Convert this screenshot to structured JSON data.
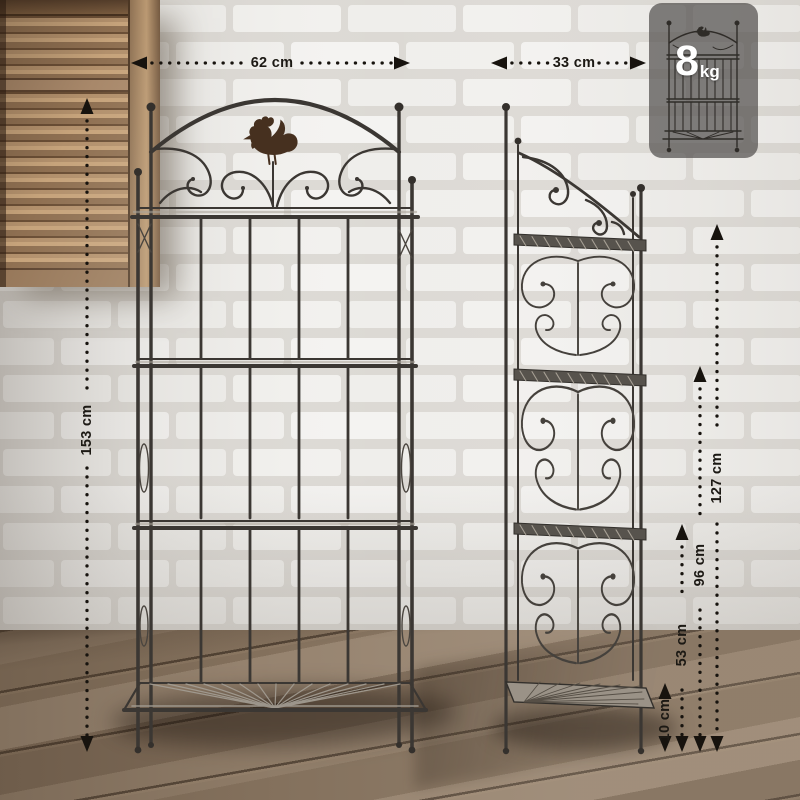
{
  "dimensions": {
    "front_width": "62 cm",
    "side_depth": "33 cm",
    "total_height": "153 cm",
    "shelf_height_top": "127 cm",
    "shelf_height_2": "96 cm",
    "shelf_height_3": "53 cm",
    "shelf_height_bottom": "10 cm"
  },
  "badge": {
    "weight_value": "8",
    "weight_unit": "kg"
  },
  "icons": {
    "rooster": "rooster-silhouette",
    "rack_outline": "folded-rack-outline",
    "dimension_arrows": "dotted-arrow-lines"
  },
  "colors": {
    "wall_mortar": "#dcd9d4",
    "wall_brick": "#f2f1ee",
    "floor_light": "#96836f",
    "floor_dark": "#7c6956",
    "shutter_wood": "#a8886a",
    "metal": "#3b3733",
    "badge_background": "rgba(78,76,74,0.70)",
    "label_text": "#1c1914"
  }
}
